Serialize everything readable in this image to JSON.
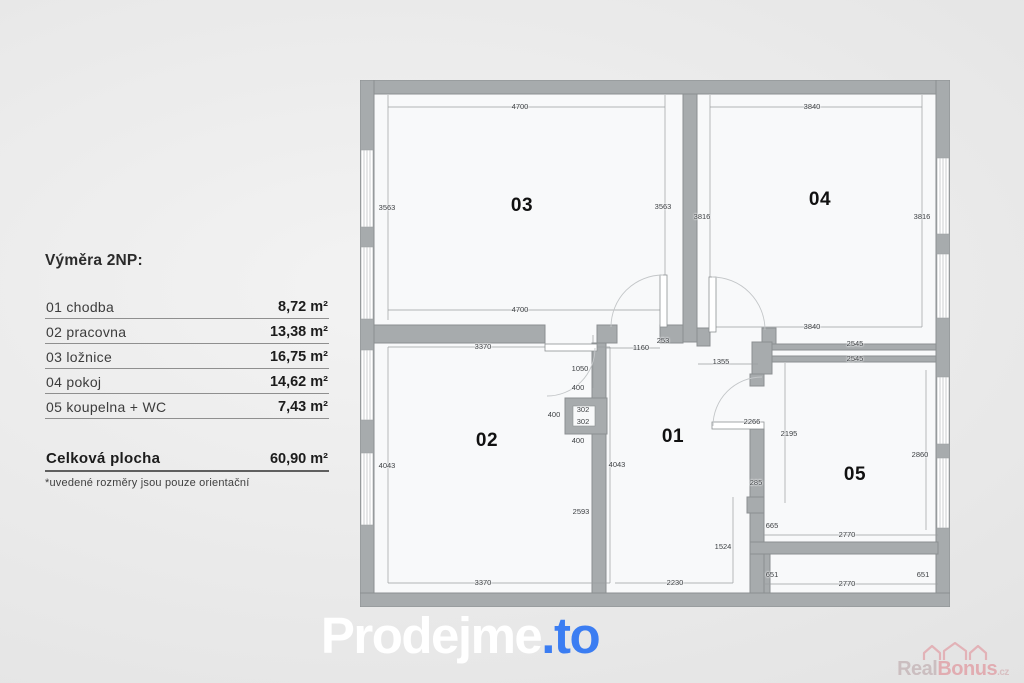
{
  "legend": {
    "title": "Výměra 2NP:",
    "rows": [
      {
        "label": "01 chodba",
        "value": "8,72 m²"
      },
      {
        "label": "02 pracovna",
        "value": "13,38 m²"
      },
      {
        "label": "03 ložnice",
        "value": "16,75 m²"
      },
      {
        "label": "04 pokoj",
        "value": "14,62 m²"
      },
      {
        "label": "05 koupelna + WC",
        "value": "7,43 m²"
      }
    ],
    "total": {
      "label": "Celková plocha",
      "value": "60,90 m²"
    },
    "note": "*uvedené rozměry jsou pouze orientační"
  },
  "branding": {
    "logo_main": "Prodejme",
    "logo_suffix": ".to",
    "logo_accent_color": "#3b7df2",
    "watermark_main_1": "Real",
    "watermark_main_2": "Bonus",
    "watermark_suffix": ".cz"
  },
  "floor_plan": {
    "floor": "2NP",
    "rooms": [
      {
        "n": "01",
        "x": 313,
        "y": 358
      },
      {
        "n": "02",
        "x": 127,
        "y": 362
      },
      {
        "n": "03",
        "x": 162,
        "y": 127
      },
      {
        "n": "04",
        "x": 460,
        "y": 121
      },
      {
        "n": "05",
        "x": 495,
        "y": 396
      }
    ],
    "dimensions": [
      {
        "t": "4700",
        "x": 160,
        "y": 27
      },
      {
        "t": "3563",
        "x": 27,
        "y": 128
      },
      {
        "t": "3563",
        "x": 303,
        "y": 127
      },
      {
        "t": "4700",
        "x": 160,
        "y": 230
      },
      {
        "t": "3840",
        "x": 452,
        "y": 27
      },
      {
        "t": "3816",
        "x": 342,
        "y": 137
      },
      {
        "t": "3816",
        "x": 562,
        "y": 137
      },
      {
        "t": "3840",
        "x": 452,
        "y": 247
      },
      {
        "t": "2545",
        "x": 495,
        "y": 264
      },
      {
        "t": "2545",
        "x": 495,
        "y": 279
      },
      {
        "t": "3370",
        "x": 123,
        "y": 267
      },
      {
        "t": "1160",
        "x": 281,
        "y": 268
      },
      {
        "t": "253",
        "x": 303,
        "y": 261
      },
      {
        "t": "1355",
        "x": 361,
        "y": 282
      },
      {
        "t": "1050",
        "x": 220,
        "y": 289
      },
      {
        "t": "400",
        "x": 218,
        "y": 308
      },
      {
        "t": "400",
        "x": 194,
        "y": 335
      },
      {
        "t": "302",
        "x": 223,
        "y": 330
      },
      {
        "t": "302",
        "x": 223,
        "y": 342
      },
      {
        "t": "400",
        "x": 218,
        "y": 361
      },
      {
        "t": "2266",
        "x": 392,
        "y": 342
      },
      {
        "t": "2195",
        "x": 429,
        "y": 354
      },
      {
        "t": "4043",
        "x": 27,
        "y": 386
      },
      {
        "t": "4043",
        "x": 257,
        "y": 385
      },
      {
        "t": "2860",
        "x": 560,
        "y": 375
      },
      {
        "t": "2593",
        "x": 221,
        "y": 432
      },
      {
        "t": "285",
        "x": 396,
        "y": 403
      },
      {
        "t": "665",
        "x": 412,
        "y": 446
      },
      {
        "t": "1524",
        "x": 363,
        "y": 467
      },
      {
        "t": "2770",
        "x": 487,
        "y": 455
      },
      {
        "t": "651",
        "x": 412,
        "y": 495
      },
      {
        "t": "651",
        "x": 563,
        "y": 495
      },
      {
        "t": "2770",
        "x": 487,
        "y": 504
      },
      {
        "t": "3370",
        "x": 123,
        "y": 503
      },
      {
        "t": "2230",
        "x": 315,
        "y": 503
      }
    ]
  }
}
